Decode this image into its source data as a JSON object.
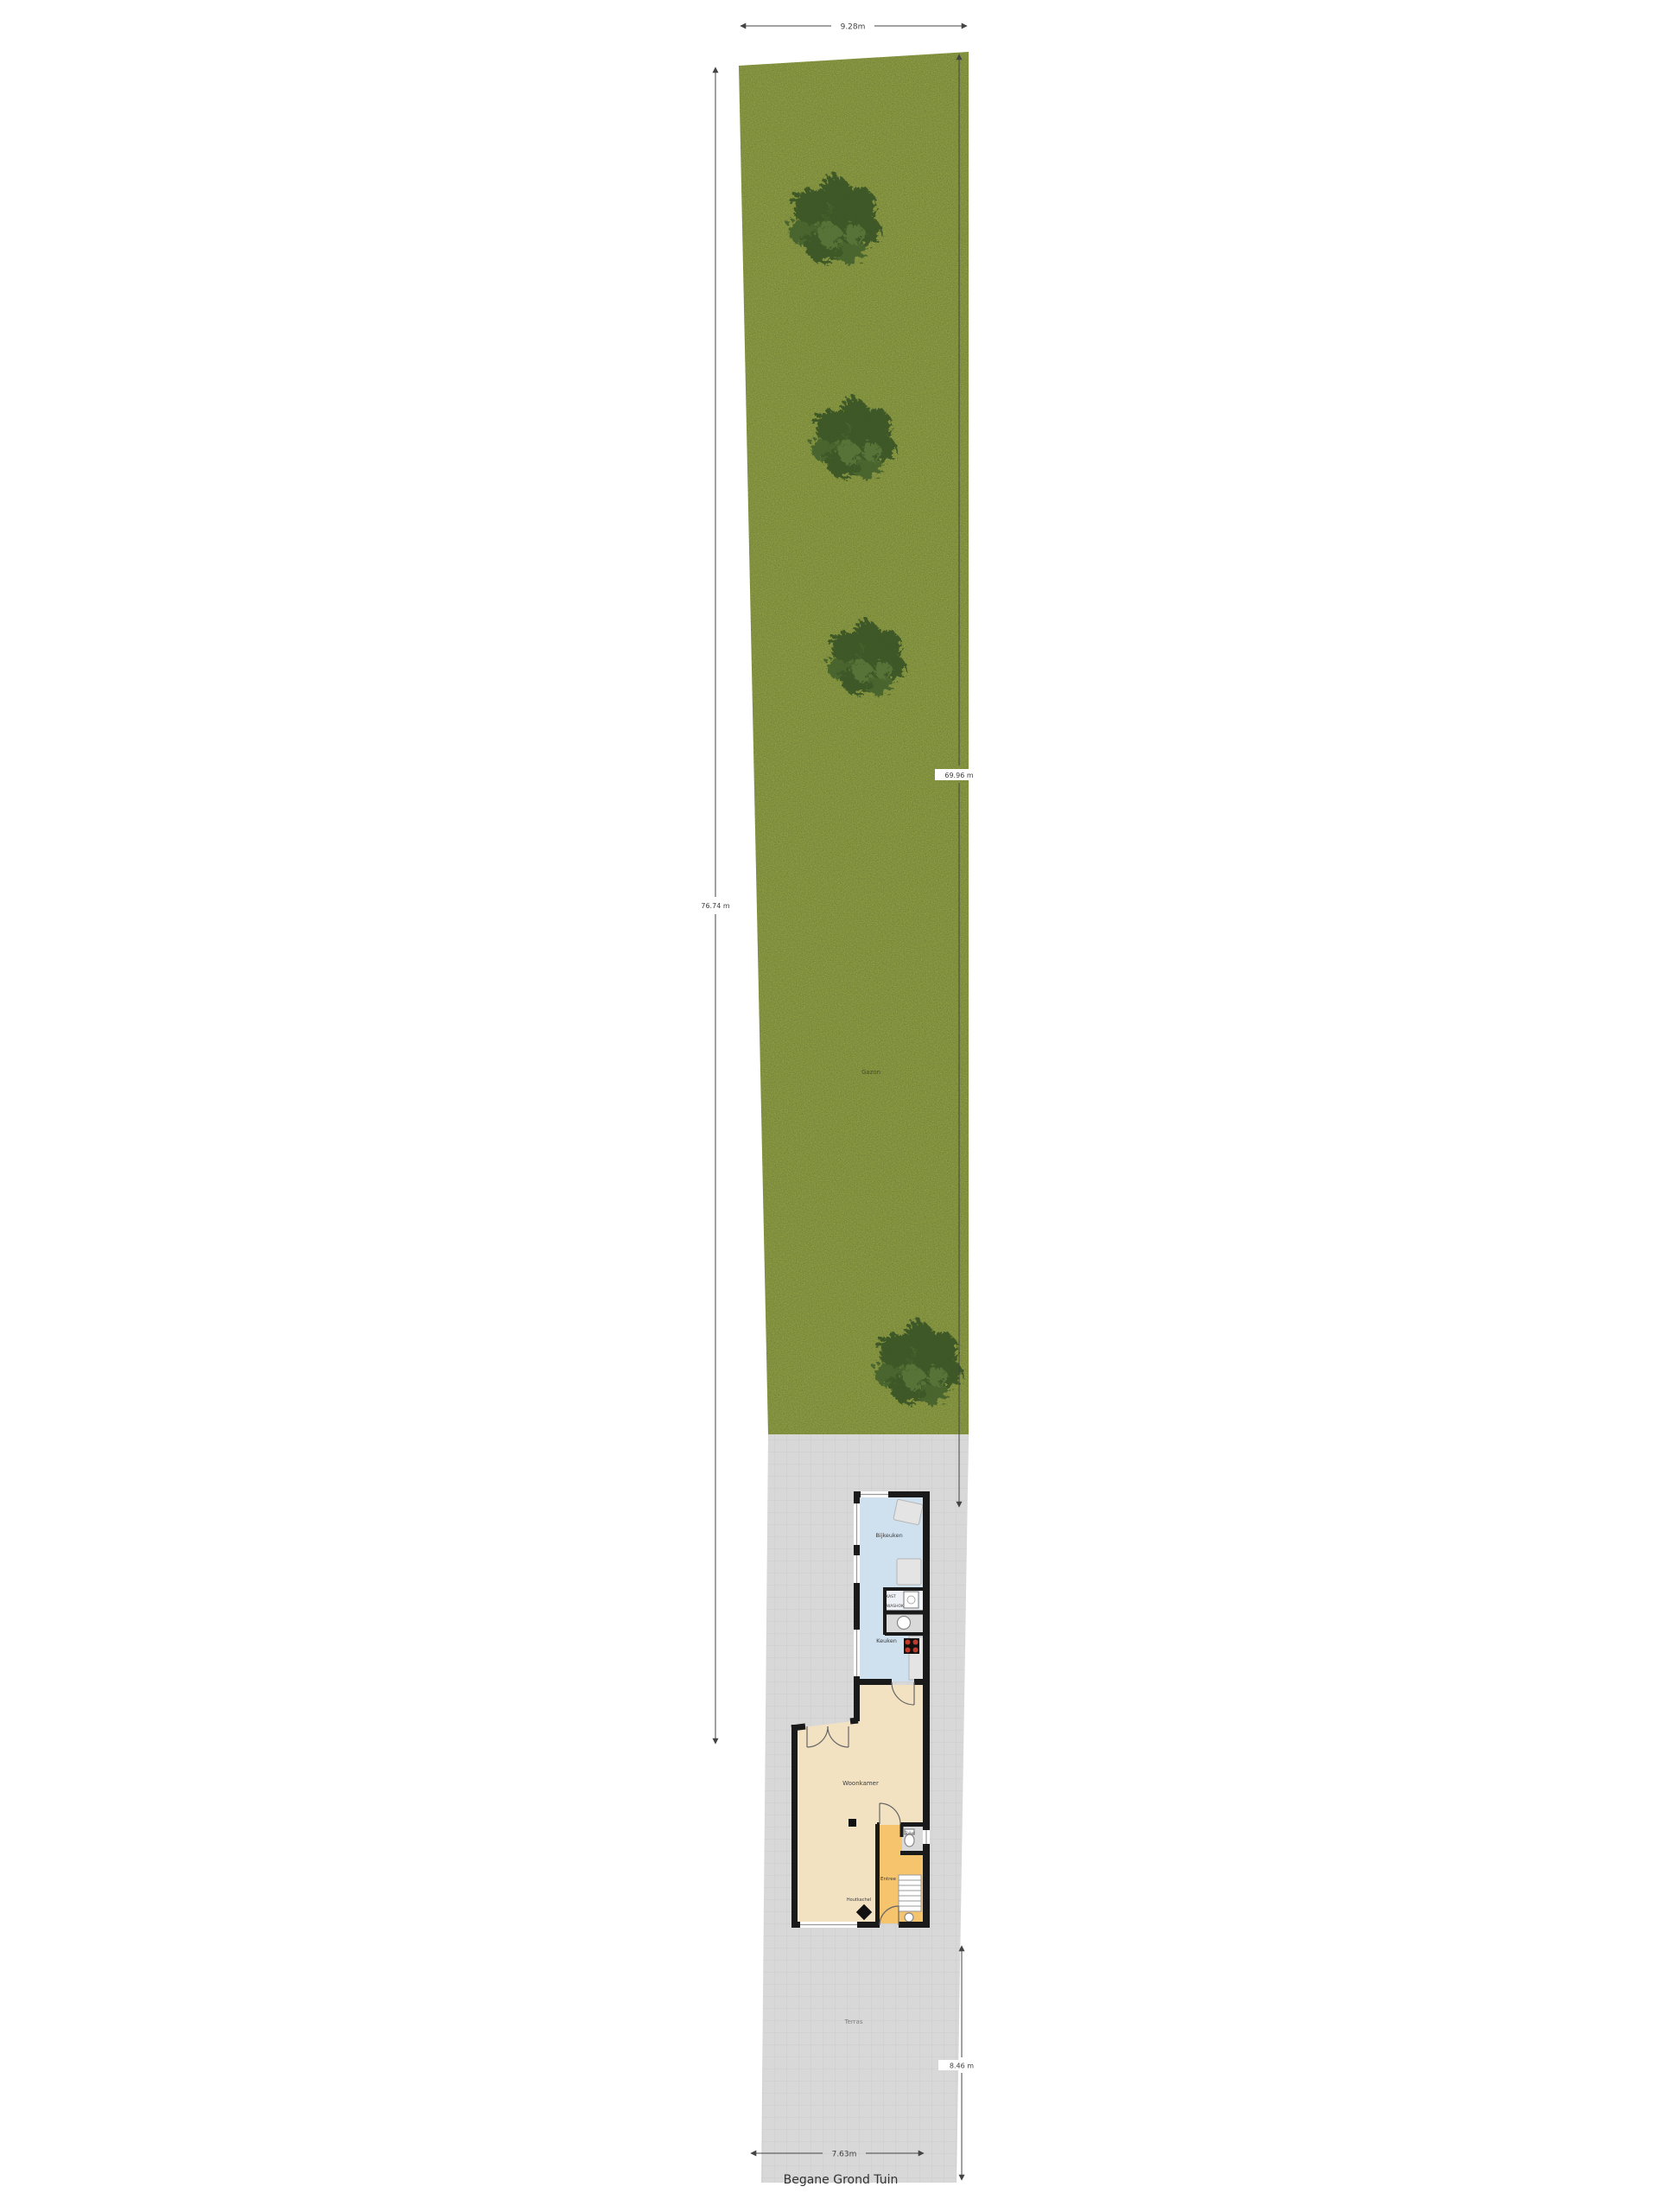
{
  "title": "Begane Grond Tuin",
  "site": {
    "garden_label": "Gazon",
    "paving_label": "Terras"
  },
  "dimensions": {
    "top": "9.28m",
    "left": "76.74 m",
    "right": "69.96 m",
    "front": "8.46 m",
    "bottom": "7.63m"
  },
  "rooms": {
    "utility": "Bijkeuken",
    "closet": "KAST",
    "laundry": "WASHOK",
    "kitchen": "Keuken",
    "living": "Woonkamer",
    "stove": "Houtkachel",
    "toilet": "Toilet",
    "hall": "Entree"
  },
  "colors": {
    "grass": "#90a146",
    "tree_dark": "#3a5526",
    "tree_mid": "#47642f",
    "tree_light": "#547237",
    "paving": "#d8d8d8",
    "paving_line": "#cccccc",
    "wall": "#1a1a1a",
    "floor_utility": "#cfe0ee",
    "floor_closet": "#eef1f5",
    "floor_wet": "#d9d9d9",
    "floor_living": "#f3e2c2",
    "floor_hall": "#f6c46d",
    "dim": "#444444"
  }
}
